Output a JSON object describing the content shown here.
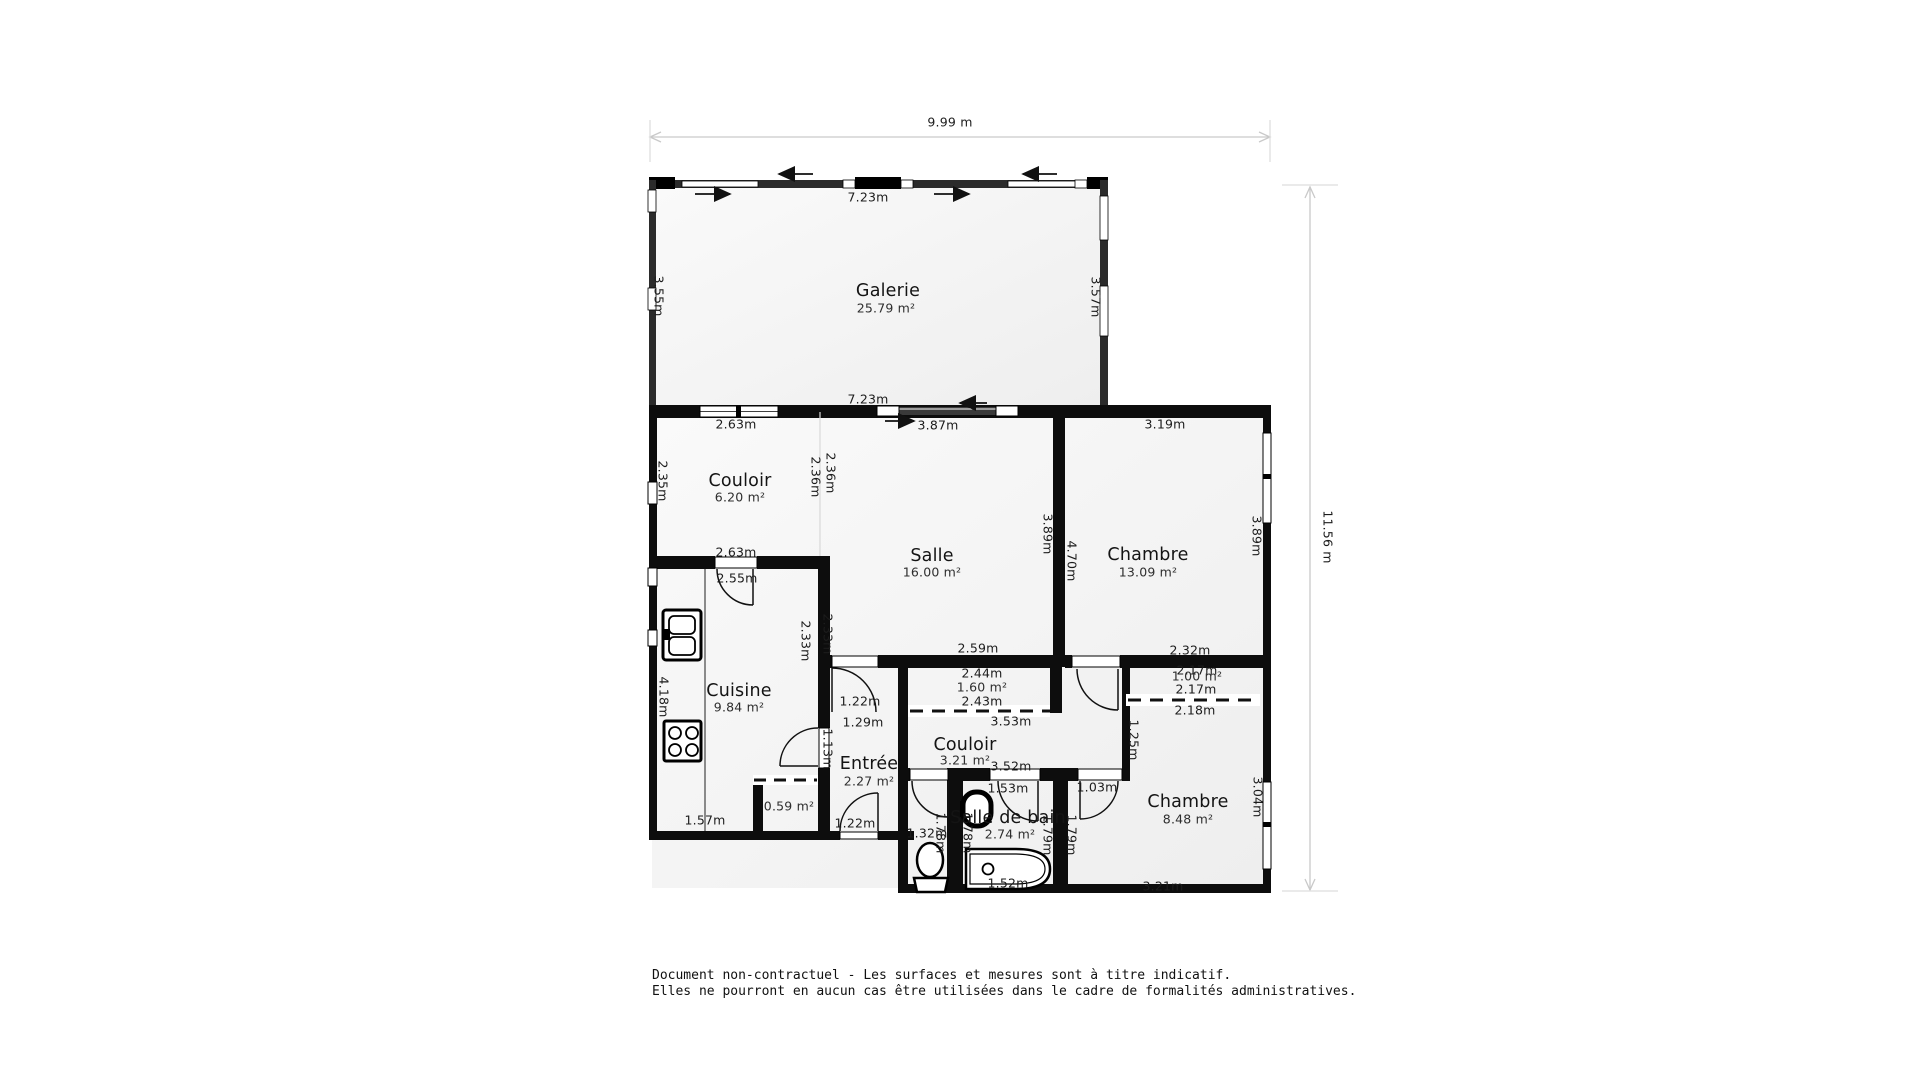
{
  "colors": {
    "wall": "#0d0d0d",
    "veranda_wall": "#2b2b2b",
    "floor": "#f5f5f5",
    "dimension_line": "#c9c9c9",
    "text": "#1c1c1c"
  },
  "overall": {
    "width": "9.99 m",
    "height": "11.56 m"
  },
  "rooms": {
    "galerie": {
      "name": "Galerie",
      "area": "25.79 m²",
      "dim_top": "7.23m",
      "dim_bottom": "7.23m",
      "dim_left": "3.55m",
      "dim_right": "3.57m"
    },
    "couloir_haut": {
      "name": "Couloir",
      "area": "6.20 m²",
      "dim_top": "2.63m",
      "dim_left": "2.35m",
      "dim_right_couloir": "2.36m",
      "dim_right_salle": "2.36m",
      "dim_bottom": "2.63m"
    },
    "salle": {
      "name": "Salle",
      "area": "16.00 m²",
      "dim_top": "3.87m",
      "dim_right": "3.89m",
      "dim_bottom": "2.59m"
    },
    "chambre_haut": {
      "name": "Chambre",
      "area": "13.09 m²",
      "dim_top": "3.19m",
      "dim_left": "4.70m",
      "dim_right": "3.89m",
      "dim_bottom": "2.32m"
    },
    "placard_salle": {
      "dim_top": "2.44m",
      "area": "1.60 m²",
      "dim_bottom": "2.43m"
    },
    "placard_chambre": {
      "dim_top": "2.17m",
      "area": "1.00 m²",
      "dim_bottom": "2.17m",
      "dim_below": "2.18m",
      "dim_left": "1.25m"
    },
    "couloir_bas": {
      "name": "Couloir",
      "area": "3.21 m²",
      "dim_top": "3.53m",
      "dim_bottom": "3.52m",
      "door_entree": "1.22m",
      "passage": "1.29m",
      "door_sdb": "1.53m",
      "door_chambre": "1.03m"
    },
    "cuisine": {
      "name": "Cuisine",
      "area": "9.84 m²",
      "dim_top": "2.55m",
      "dim_left": "4.18m",
      "dim_right_cuisine": "2.33m",
      "dim_right_salle": "2.33m",
      "dim_right_bas": "1.13m",
      "dim_bottom": "1.57m"
    },
    "placard_cuisine": {
      "area": "0.59 m²"
    },
    "entree": {
      "name": "Entrée",
      "area": "2.27 m²",
      "door": "1.22m"
    },
    "wc": {
      "dim_width": "1.32m",
      "dim_right_wc": "1.78m",
      "dim_right_sdb": "1.78m"
    },
    "salle_de_bain": {
      "name": "Salle de bain",
      "area": "2.74 m²",
      "dim_right_sdb": "1.79m",
      "dim_right_chambre": "1.79m",
      "bath_width": "1.52m"
    },
    "chambre_bas": {
      "name": "Chambre",
      "area": "8.48 m²",
      "dim_right": "3.04m",
      "dim_bottom": "3.21m"
    }
  },
  "disclaimer": [
    "Document non-contractuel - Les surfaces et mesures sont à titre indicatif.",
    "Elles ne pourront en aucun cas être utilisées dans le cadre de formalités administratives."
  ]
}
